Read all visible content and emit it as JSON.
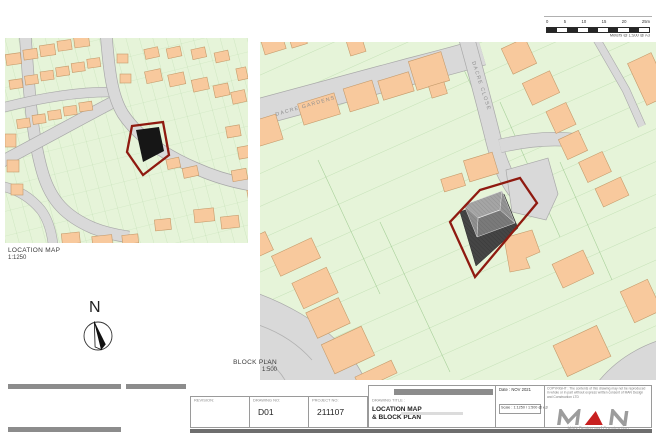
{
  "colors": {
    "building": "#f8c99d",
    "building_stroke": "#c59b6b",
    "land": "#e6f4d9",
    "parcel": "#98c78a",
    "road": "#d9d9d9",
    "road_stroke": "#a9a9a9",
    "site_red": "#8f1a10",
    "redact": "#8c8c8c",
    "bar_dark": "#6e6e6e"
  },
  "scalebar": {
    "tick_labels": [
      "0",
      "5",
      "10",
      "15",
      "20",
      "25m"
    ],
    "caption": "Meters @ 1:500 @ A3"
  },
  "location_map": {
    "label": "LOCATION MAP",
    "scale": "1:1250"
  },
  "block_plan": {
    "label": "BLOCK PLAN",
    "scale": "1:500",
    "streets": {
      "dacre_gardens": "DACRE GARDENS",
      "dacre_close": "DACRE CLOSE"
    }
  },
  "north": {
    "label": "N"
  },
  "title_block": {
    "notes_lines": [
      "Drawings to be read in conjunction with relevant drawings and reports.",
      "Drawings cannot be scaled, figured dimensions taken only.",
      "Any discrepancies are to be pointed to the agent immediately.",
      "Agent/General Contractor. This figure is not liable for any faults and related drawings not to be used for other intended purposes."
    ],
    "contact": {
      "tel": "TEL : 07486724487",
      "email": "email : man.designcs@gmail.com",
      "web": "web : manstudio.co.uk"
    },
    "fields": {
      "revision_label": "REVISION:",
      "drawing_no_label": "DRAWING NO:",
      "drawing_no_value": "D01",
      "project_no_label": "PROJECT NO:",
      "project_no_value": "211107",
      "title_label": "DRAWING TITLE :",
      "title_line1": "LOCATION MAP",
      "title_line2": "& BLOCK PLAN",
      "date_value": "Date :  NOV 2021",
      "scale_value": "Scale : 1:1250 / 1:500 @ A3"
    },
    "copyright": "COPYRIGHT : The contents of this drawing may not be reproduced in whole or in part without express written consent of MAN Design and Construction LTD",
    "logo": {
      "tagline": "MAN Design and Construction"
    }
  }
}
